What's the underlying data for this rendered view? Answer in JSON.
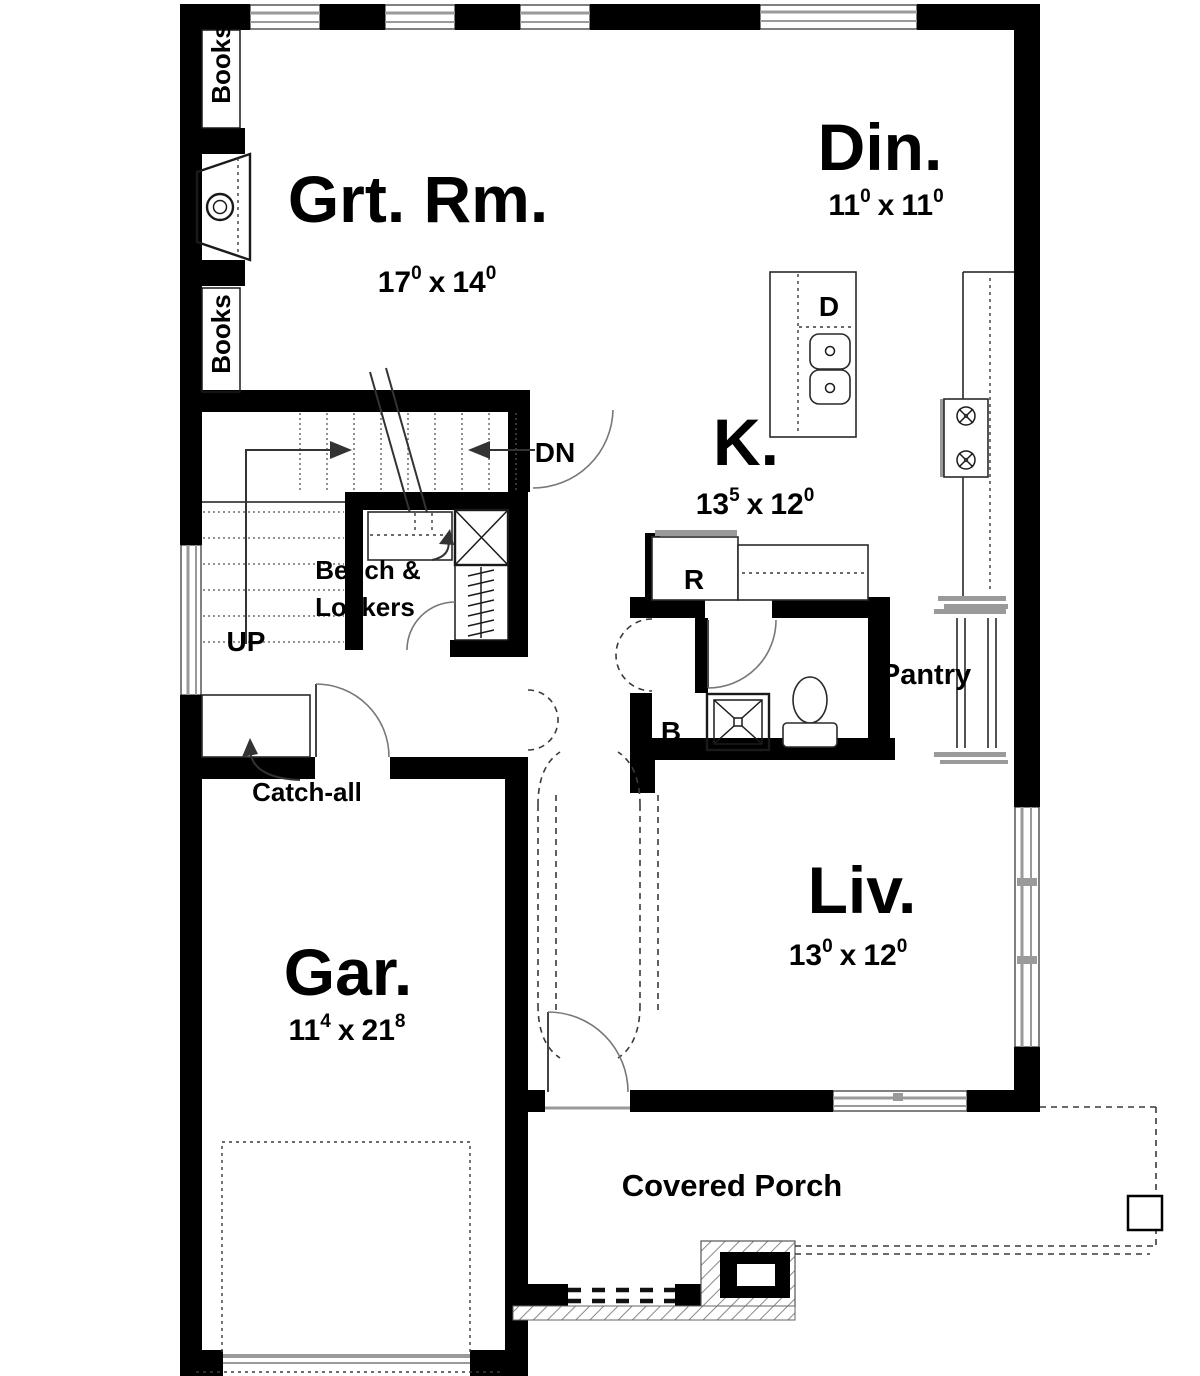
{
  "plan": {
    "rooms": {
      "great_room": {
        "label": "Grt. Rm.",
        "dim": {
          "a": "17",
          "a_sup": "0",
          "mult": "x",
          "b": "14",
          "b_sup": "0"
        }
      },
      "dining": {
        "label": "Din.",
        "dim": {
          "a": "11",
          "a_sup": "0",
          "mult": "x",
          "b": "11",
          "b_sup": "0"
        }
      },
      "kitchen": {
        "label": "K.",
        "dim": {
          "a": "13",
          "a_sup": "5",
          "mult": "x",
          "b": "12",
          "b_sup": "0"
        }
      },
      "living": {
        "label": "Liv.",
        "dim": {
          "a": "13",
          "a_sup": "0",
          "mult": "x",
          "b": "12",
          "b_sup": "0"
        }
      },
      "garage": {
        "label": "Gar.",
        "dim": {
          "a": "11",
          "a_sup": "4",
          "mult": "x",
          "b": "21",
          "b_sup": "8"
        }
      },
      "porch": {
        "label": "Covered Porch"
      },
      "pantry": {
        "label": "Pantry"
      }
    },
    "annotations": {
      "books_upper": "Books",
      "books_lower": "Books",
      "up": "UP",
      "dn": "DN",
      "bench_line1": "Bench &",
      "bench_line2": "Lockers",
      "catch_all": "Catch-all",
      "bath": "B",
      "refrigerator": "R",
      "dishwasher": "D"
    },
    "colors": {
      "wall": "#000000",
      "window": "#9a9a9a",
      "hatch": "#888888",
      "dashed_line": "#3a3a3a",
      "text": "#000000",
      "background": "#ffffff"
    }
  }
}
